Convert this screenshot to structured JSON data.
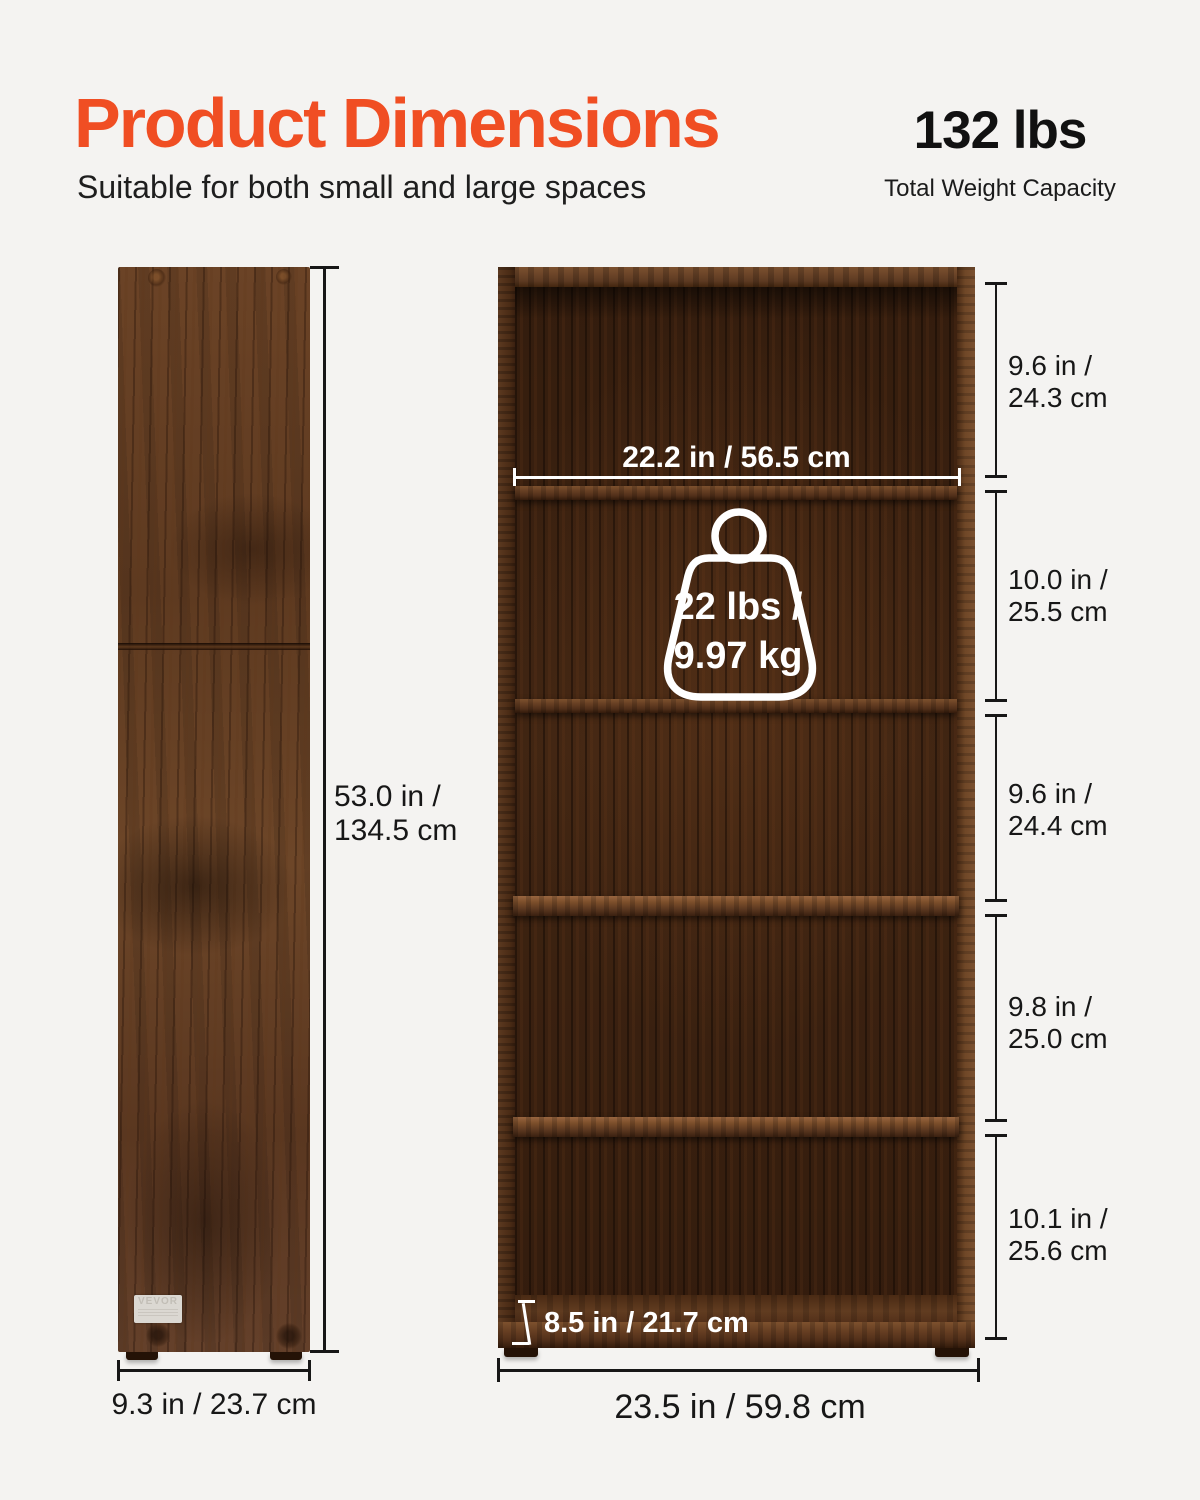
{
  "header": {
    "title": "Product Dimensions",
    "subtitle": "Suitable for both small and large spaces",
    "weight_value": "132 lbs",
    "weight_caption": "Total Weight Capacity"
  },
  "side_view": {
    "height_line1": "53.0 in /",
    "height_line2": "134.5 cm",
    "width_label": "9.3 in / 23.7 cm",
    "brand_label": "VEVOR"
  },
  "front_view": {
    "inner_width_label": "22.2 in / 56.5 cm",
    "capacity_line1": "22 lbs /",
    "capacity_line2": "9.97 kg",
    "capacity_icon": "weight-kettlebell-outline-icon",
    "depth_label": "8.5 in / 21.7 cm",
    "width_label": "23.5 in / 59.8 cm",
    "shelf_heights": [
      {
        "line1": "9.6 in /",
        "line2": "24.3 cm"
      },
      {
        "line1": "10.0 in /",
        "line2": "25.5 cm"
      },
      {
        "line1": "9.6 in /",
        "line2": "24.4 cm"
      },
      {
        "line1": "9.8 in /",
        "line2": "25.0 cm"
      },
      {
        "line1": "10.1 in /",
        "line2": "25.6 cm"
      }
    ]
  },
  "colors": {
    "accent": "#f04e23",
    "text": "#171717",
    "background": "#f4f3f1",
    "wood_mid": "#5e3a20",
    "wood_dark": "#331c0d",
    "dimension_white": "#ffffff"
  }
}
